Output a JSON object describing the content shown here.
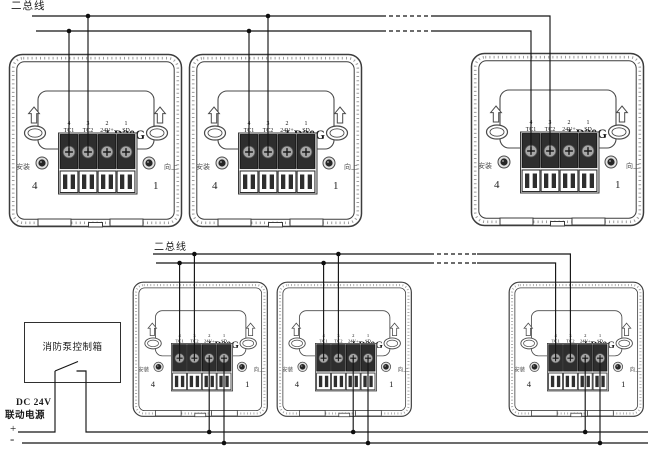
{
  "diagram": {
    "top_bus_label": "二总线",
    "bottom_bus_label": "二总线",
    "module": {
      "model": "LD20G",
      "left_side_label": "安装",
      "right_side_label": "向上",
      "corner_left_number": "4",
      "corner_right_number": "1",
      "terminals": [
        {
          "num": "4",
          "name": "TC1"
        },
        {
          "num": "3",
          "name": "TC2"
        },
        {
          "num": "2",
          "name": "24V+"
        },
        {
          "num": "1",
          "name": "SD"
        }
      ]
    },
    "control_box": {
      "label": "消防泵控制箱"
    },
    "power": {
      "line1": "DC 24V",
      "line2": "联动电源",
      "plus": "+",
      "minus": "-"
    },
    "colors": {
      "wire": "#141414",
      "line_art": "#3c3c3c",
      "terminal_dark": "#2e2e2e",
      "background": "#ffffff"
    }
  }
}
